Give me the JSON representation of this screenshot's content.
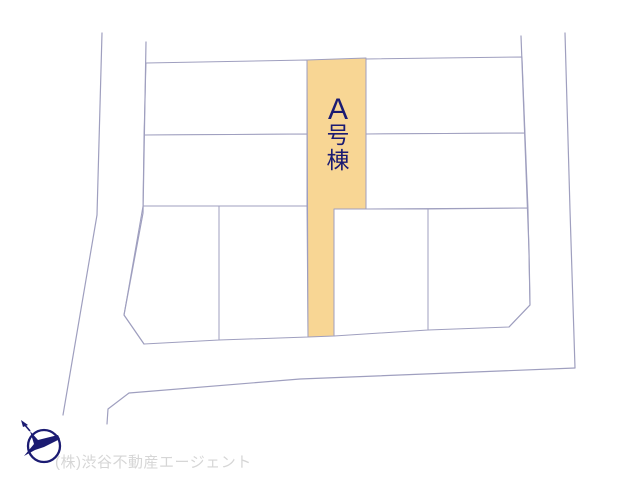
{
  "drawing": {
    "type": "lot-layout-plan",
    "highlight_parcel": {
      "label": "A号棟",
      "chars": [
        "A",
        "号",
        "棟"
      ]
    }
  },
  "footer": {
    "company_watermark": "(株)渋谷不動産エージェント"
  },
  "icons": {
    "compass": "north-compass-icon"
  },
  "colors": {
    "background": "#ffffff",
    "parcel_line": "#9f9fbf",
    "highlight_fill": "#f8d694",
    "label_text": "#1b1b72",
    "compass": "#1b1b72",
    "watermark_text": "#d6d6d6"
  }
}
